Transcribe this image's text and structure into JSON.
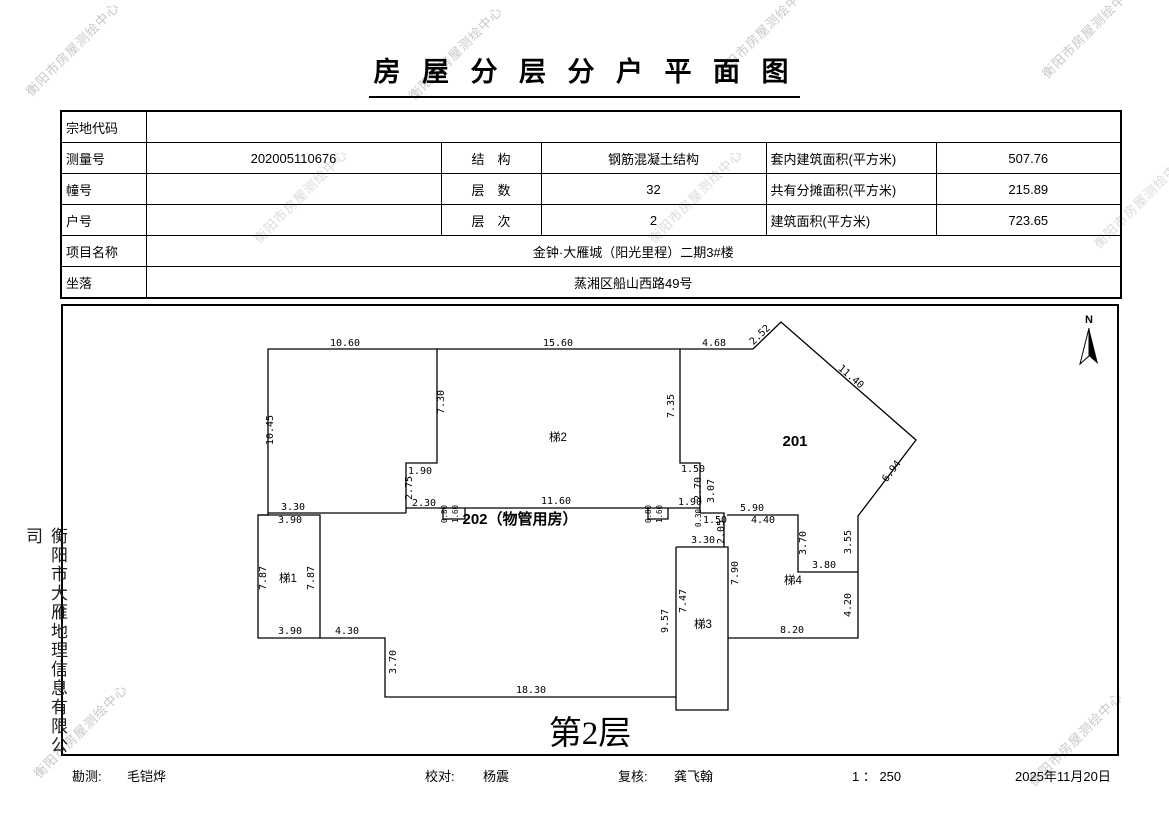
{
  "title": "房 屋 分 层 分 户 平 面 图",
  "watermark_text": "衡阳市房屋测绘中心",
  "side_company": "衡阳市大雁地理信息有限公司",
  "watermarks": [
    {
      "x": 72,
      "y": 48
    },
    {
      "x": 455,
      "y": 52
    },
    {
      "x": 762,
      "y": 30
    },
    {
      "x": 1088,
      "y": 30
    },
    {
      "x": 300,
      "y": 195,
      "light": true
    },
    {
      "x": 695,
      "y": 195,
      "light": true
    },
    {
      "x": 1140,
      "y": 200,
      "light": true
    },
    {
      "x": 80,
      "y": 730
    },
    {
      "x": 1075,
      "y": 738
    }
  ],
  "table": {
    "rows": [
      {
        "label": "宗地代码",
        "value": ""
      },
      {
        "label": "测量号",
        "value": "202005110676",
        "label2": "结　构",
        "value2": "钢筋混凝土结构",
        "label3": "套内建筑面积(平方米)",
        "value3": "507.76"
      },
      {
        "label": "幢号",
        "value": "",
        "label2": "层　数",
        "value2": "32",
        "label3": "共有分摊面积(平方米)",
        "value3": "215.89"
      },
      {
        "label": "户号",
        "value": "",
        "label2": "层　次",
        "value2": "2",
        "label3": "建筑面积(平方米)",
        "value3": "723.65"
      },
      {
        "label": "项目名称",
        "value": "金钟·大雁城（阳光里程）二期3#楼"
      },
      {
        "label": "坐落",
        "value": "蒸湘区船山西路49号"
      }
    ]
  },
  "plan": {
    "caption": "第2层",
    "north_label": "N",
    "rooms": [
      {
        "t": "201",
        "x": 795,
        "y": 446,
        "cls": "room-big"
      },
      {
        "t": "202（物管用房）",
        "x": 520,
        "y": 524,
        "cls": "room-big"
      },
      {
        "t": "梯1",
        "x": 288,
        "y": 582,
        "cls": "room-small"
      },
      {
        "t": "梯2",
        "x": 558,
        "y": 441,
        "cls": "room-small"
      },
      {
        "t": "梯3",
        "x": 703,
        "y": 628,
        "cls": "room-small"
      },
      {
        "t": "梯4",
        "x": 793,
        "y": 584,
        "cls": "room-small"
      }
    ],
    "dims": [
      {
        "t": "10.60",
        "x": 345,
        "y": 346,
        "r": 0
      },
      {
        "t": "15.60",
        "x": 558,
        "y": 346,
        "r": 0
      },
      {
        "t": "4.68",
        "x": 714,
        "y": 346,
        "r": 0
      },
      {
        "t": "2.52",
        "x": 762,
        "y": 337,
        "r": -44
      },
      {
        "t": "11.40",
        "x": 849,
        "y": 379,
        "r": 41
      },
      {
        "t": "6.94",
        "x": 894,
        "y": 473,
        "r": -53
      },
      {
        "t": "10.45",
        "x": 273,
        "y": 430,
        "r": -90
      },
      {
        "t": "7.30",
        "x": 444,
        "y": 402,
        "r": -90
      },
      {
        "t": "7.35",
        "x": 674,
        "y": 406,
        "r": -90
      },
      {
        "t": "1.90",
        "x": 420,
        "y": 474,
        "r": 0
      },
      {
        "t": "2.75",
        "x": 412,
        "y": 488,
        "r": -90
      },
      {
        "t": "2.30",
        "x": 424,
        "y": 506,
        "r": 0
      },
      {
        "t": "11.60",
        "x": 556,
        "y": 504,
        "r": 0
      },
      {
        "t": "0.80",
        "x": 447,
        "y": 514,
        "r": -90,
        "sz": "tiny"
      },
      {
        "t": "1.60",
        "x": 458,
        "y": 514,
        "r": -90,
        "sz": "tiny"
      },
      {
        "t": "0.80",
        "x": 651,
        "y": 514,
        "r": -90,
        "sz": "tiny"
      },
      {
        "t": "1.60",
        "x": 662,
        "y": 514,
        "r": -90,
        "sz": "tiny"
      },
      {
        "t": "1.50",
        "x": 693,
        "y": 472,
        "r": 0
      },
      {
        "t": "2.70",
        "x": 701,
        "y": 489,
        "r": -90
      },
      {
        "t": "3.07",
        "x": 714,
        "y": 491,
        "r": -90
      },
      {
        "t": "1.90",
        "x": 690,
        "y": 505,
        "r": 0
      },
      {
        "t": "0.30",
        "x": 701,
        "y": 518,
        "r": -90,
        "sz": "tiny"
      },
      {
        "t": "1.50",
        "x": 715,
        "y": 523,
        "r": 0
      },
      {
        "t": "2.05",
        "x": 724,
        "y": 532,
        "r": -90
      },
      {
        "t": "5.90",
        "x": 752,
        "y": 511,
        "r": 0
      },
      {
        "t": "4.40",
        "x": 763,
        "y": 523,
        "r": 0
      },
      {
        "t": "3.30",
        "x": 703,
        "y": 543,
        "r": 0
      },
      {
        "t": "3.30",
        "x": 293,
        "y": 510,
        "r": 0
      },
      {
        "t": "3.90",
        "x": 290,
        "y": 523,
        "r": 0
      },
      {
        "t": "7.87",
        "x": 266,
        "y": 578,
        "r": -90
      },
      {
        "t": "7.87",
        "x": 314,
        "y": 578,
        "r": -90
      },
      {
        "t": "3.90",
        "x": 290,
        "y": 634,
        "r": 0
      },
      {
        "t": "4.30",
        "x": 347,
        "y": 634,
        "r": 0
      },
      {
        "t": "3.70",
        "x": 396,
        "y": 662,
        "r": -90
      },
      {
        "t": "18.30",
        "x": 531,
        "y": 693,
        "r": 0
      },
      {
        "t": "9.57",
        "x": 668,
        "y": 621,
        "r": -90
      },
      {
        "t": "7.47",
        "x": 686,
        "y": 601,
        "r": -90
      },
      {
        "t": "7.90",
        "x": 738,
        "y": 573,
        "r": -90
      },
      {
        "t": "3.70",
        "x": 806,
        "y": 543,
        "r": -90
      },
      {
        "t": "3.55",
        "x": 851,
        "y": 542,
        "r": -90
      },
      {
        "t": "3.80",
        "x": 824,
        "y": 568,
        "r": 0
      },
      {
        "t": "4.20",
        "x": 851,
        "y": 605,
        "r": -90
      },
      {
        "t": "8.20",
        "x": 792,
        "y": 633,
        "r": 0
      }
    ]
  },
  "footer": {
    "survey_label": "勘测:",
    "survey_value": "毛铠烨",
    "proof_label": "校对:",
    "proof_value": "杨震",
    "review_label": "复核:",
    "review_value": "龚飞翰",
    "scale": "1 ： 250",
    "date": "2025年11月20日"
  }
}
